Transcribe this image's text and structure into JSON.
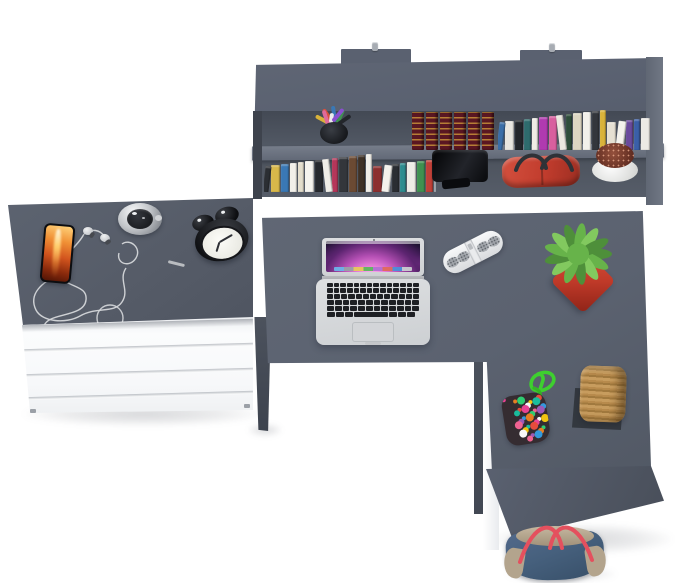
{
  "scene": {
    "type": "3d-product-render",
    "description": "Top-down 3D render of a gray and white corner desk set on a white background: a wall-mounted shelf unit full of books, a chest of drawers with a smartphone, earphones, pocket watch and alarm clock, and an L-shaped desk with an open laptop, portable speaker, green plant in a red pot, rope basket, pom-pom pouch and a denim tote bag on the floor",
    "background": "#ffffff"
  },
  "palette": {
    "desk_gray": "#5d6471",
    "dresser_gray": "#565c68",
    "hutch_gray": "#5b6270",
    "interior_shadow": "#4a505b",
    "shelf_edge": "#767d8a",
    "panel_white": "#fafbfc",
    "leg_gray": "#4c525d"
  },
  "furniture": {
    "hutch": {
      "label": "wall-mounted shelf unit with two mounting brackets",
      "color": "#5b6270"
    },
    "dresser": {
      "label": "white chest of four drawers with gray top",
      "top_color": "#565c68",
      "front_color": "#fafbfc",
      "drawer_count": 4
    },
    "desk": {
      "label": "gray L-shaped corner desk top",
      "color": "#5d6471"
    },
    "support_panel": {
      "label": "white center support panel",
      "color": "#fcfcfd"
    },
    "return_panel": {
      "label": "gray side panel of desk return",
      "color": "#545b67"
    }
  },
  "objects": {
    "pencil_cup": {
      "label": "black cup with pens and pencils",
      "cup_color": "#23262b",
      "pen_colors": [
        "#d94f3d",
        "#3a78b5",
        "#3f9150",
        "#d9b33a",
        "#23262b",
        "#ececec",
        "#8a4fd0",
        "#e06a9a"
      ]
    },
    "antique_books": {
      "label": "set of antique dark red books with gold ornament",
      "count": 6,
      "spine_color": "#5a1722",
      "accent_color": "#d6a03c"
    },
    "top_shelf_books": {
      "label": "row of colorful books on upper shelf",
      "spines": [
        "#3a6ea8",
        "#e8e6e0",
        "#23262b",
        "#2e6b6d",
        "#f0ede6",
        "#b03ab0",
        "#d85f9e",
        "#ece8df",
        "#2f4d3a",
        "#ddd6c2",
        "#f2f0ea",
        "#33363c",
        "#d9b33a",
        "#e6e0d2",
        "#f4f2ec",
        "#6a4a9c",
        "#3a5fa8",
        "#eceae4"
      ]
    },
    "bottom_shelf_books": {
      "label": "row of colorful books on lower shelf",
      "spines": [
        "#2b2e33",
        "#d8b84a",
        "#3a78b5",
        "#f1efe9",
        "#e3ddcc",
        "#f5f3ee",
        "#26292e",
        "#efede7",
        "#b5365a",
        "#33363b",
        "#6b4a33",
        "#3e3126",
        "#f0eee8",
        "#8c2f2f",
        "#f3f1eb",
        "#2a2d32",
        "#2e8c8f",
        "#eeece6",
        "#3f9150",
        "#c04038",
        "#9aa0a8"
      ]
    },
    "black_device": {
      "label": "glossy black desk lamp on lower shelf",
      "color": "#101114"
    },
    "red_handbag": {
      "label": "red handbag with dark handles",
      "color": "#c7422f",
      "handle_color": "#2f3237"
    },
    "dried_plant": {
      "label": "white pot with reddish dried plant",
      "pot_color": "#f2f2f0",
      "foliage_color": "#7c3527"
    },
    "smartphone": {
      "label": "smartphone showing fiery orange wallpaper",
      "body_color": "#0c0d10",
      "screen_colors": [
        "#ffd27a",
        "#e0641f",
        "#7a1f08"
      ]
    },
    "earphones": {
      "label": "white earphones with long tangled cable",
      "cable_color": "#d5d7da"
    },
    "pocket_watch": {
      "label": "silver pocket watch",
      "case_color": "#c7cacd",
      "dial_color": "#26282c"
    },
    "alarm_clock": {
      "label": "black twin-bell alarm clock",
      "body_color": "#17181c",
      "face_color": "#f1f1ec"
    },
    "laptop": {
      "label": "open silver laptop with purple aurora wallpaper",
      "body_color": "#d7d9db",
      "key_color": "#1e2024",
      "dock_colors": [
        "#6db3e8",
        "#9aa0a6",
        "#e8c85a",
        "#5bb85e",
        "#b36fd4",
        "#e06a5a",
        "#4a90d9",
        "#c9ccd0"
      ]
    },
    "speaker": {
      "label": "white pill-shaped portable speaker",
      "body_color": "#eef0f2",
      "grille_color": "#9fa3a9"
    },
    "green_plant": {
      "label": "spiky green succulent in red cube pot",
      "pot_color": "#c03a29",
      "leaf_colors": [
        "#4e8f3a",
        "#67b34a",
        "#82c95f"
      ]
    },
    "pompom_pouch": {
      "label": "multicolor pom-pom pouch with green rope",
      "rope_color": "#3ecf2f",
      "base_color": "#352c31",
      "dot_colors": [
        "#e84393",
        "#3498db",
        "#f1c40f",
        "#2ecc71",
        "#e74c3c",
        "#9b59b6",
        "#f8f8f8",
        "#e67e22",
        "#1abc9c",
        "#f06292"
      ]
    },
    "rope_basket": {
      "label": "woven rope basket on dark gray mat",
      "rope_color": "#b98d52",
      "mat_color": "#33383f"
    },
    "tote_bag": {
      "label": "denim tote bag with red straps on the floor",
      "body_color": "#46607d",
      "trim_color": "#b3a48d",
      "strap_color": "#e4505e"
    }
  }
}
